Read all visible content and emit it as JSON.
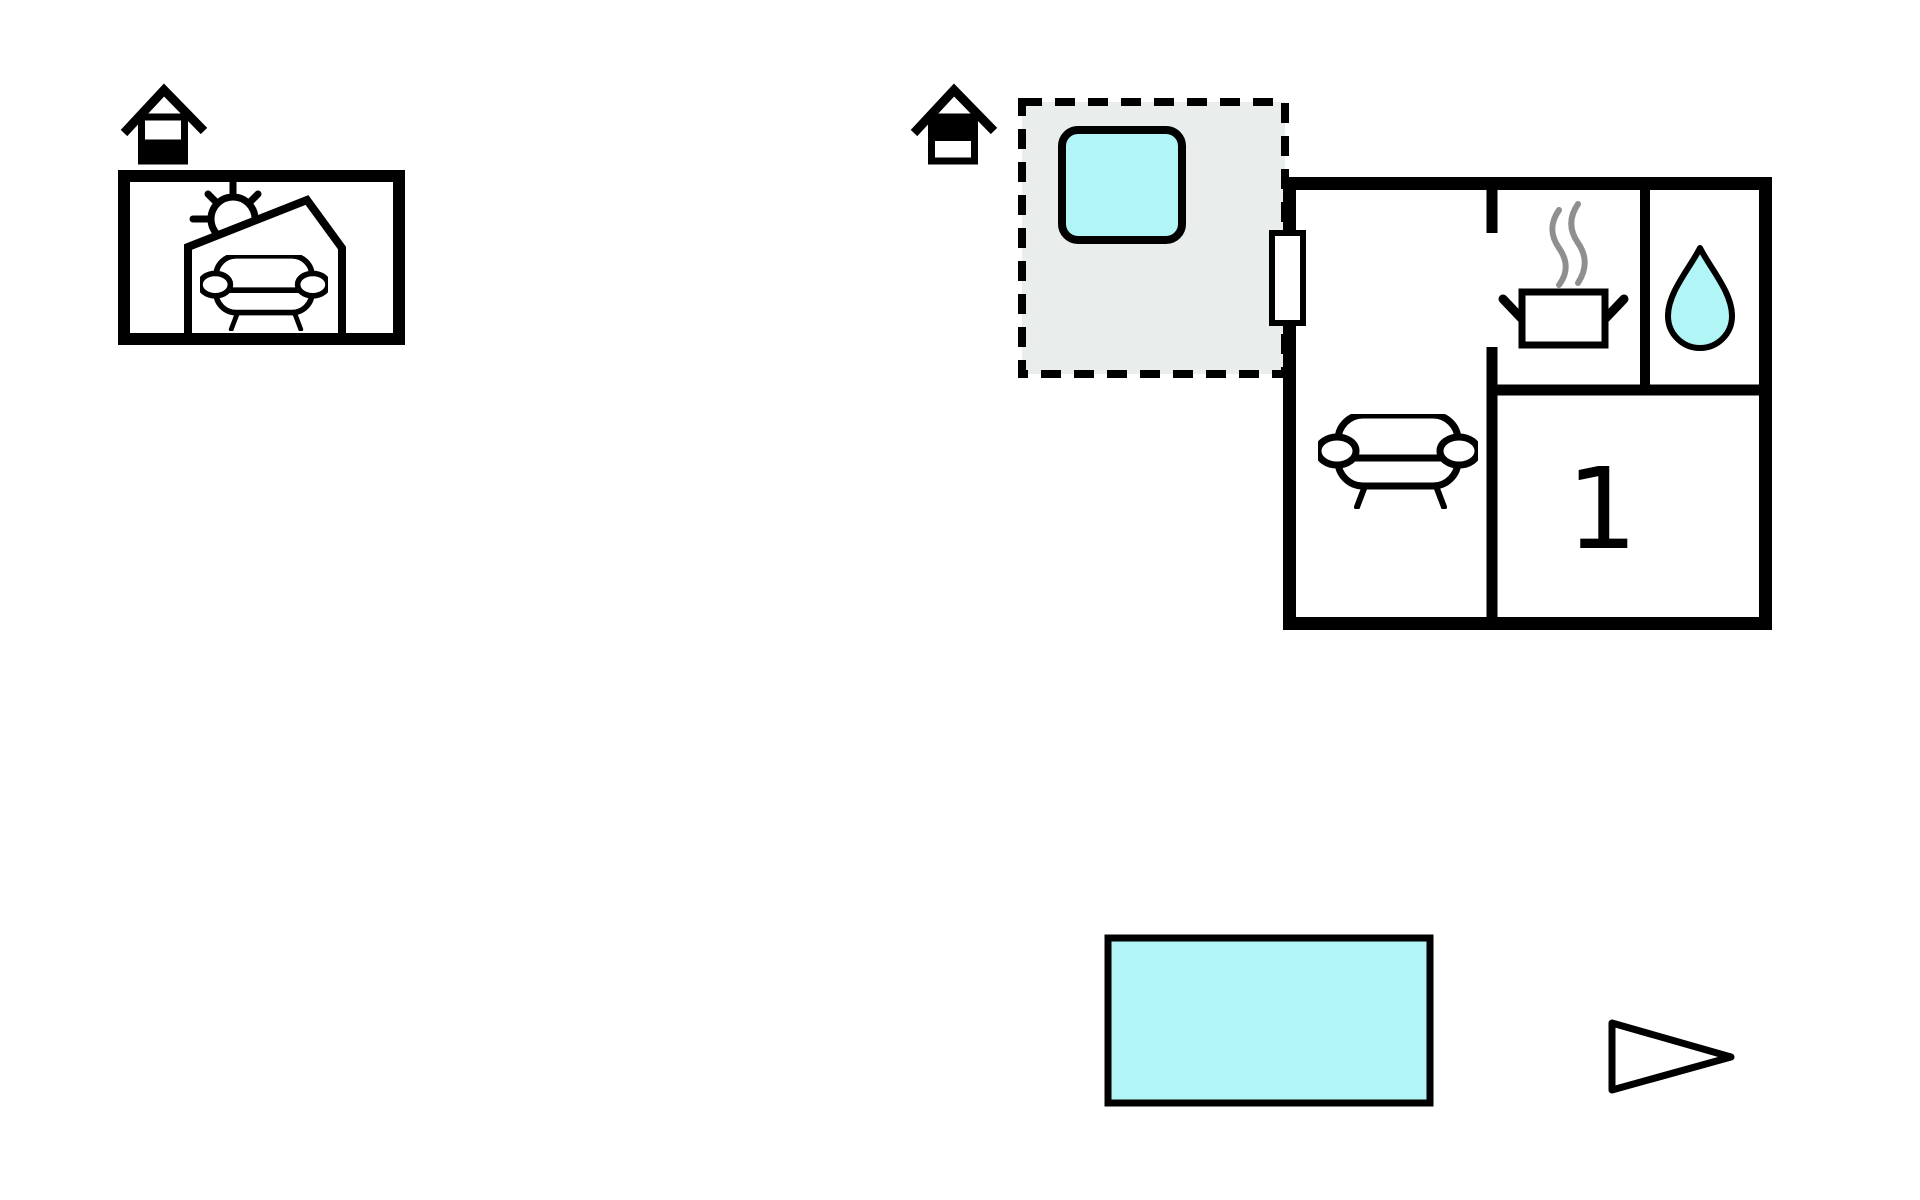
{
  "colors": {
    "water": "#b2f5f6",
    "terrace": "#e9edec",
    "ink": "#000000",
    "steam": "#8f8f8f",
    "background": "#ffffff"
  },
  "annex": {
    "floor_level_icon": "house-icon-lower-level-filled",
    "features": [
      "sun-icon",
      "open-shed-outline",
      "sofa-icon"
    ]
  },
  "main_house": {
    "floor_level_icon": "house-icon-upper-level-filled",
    "terrace": {
      "outline": "dashed",
      "features": [
        "hot-tub-icon"
      ]
    },
    "rooms": {
      "living_room": {
        "features": [
          "sofa-icon"
        ],
        "door": "entrance-door"
      },
      "kitchen": {
        "features": [
          "cooking-pot-icon",
          "steam-icon"
        ]
      },
      "bathroom": {
        "features": [
          "water-drop-icon"
        ]
      },
      "bedroom": {
        "label": "1"
      }
    }
  },
  "outdoor": {
    "features": [
      "swimming-pool",
      "direction-arrow-icon"
    ]
  }
}
